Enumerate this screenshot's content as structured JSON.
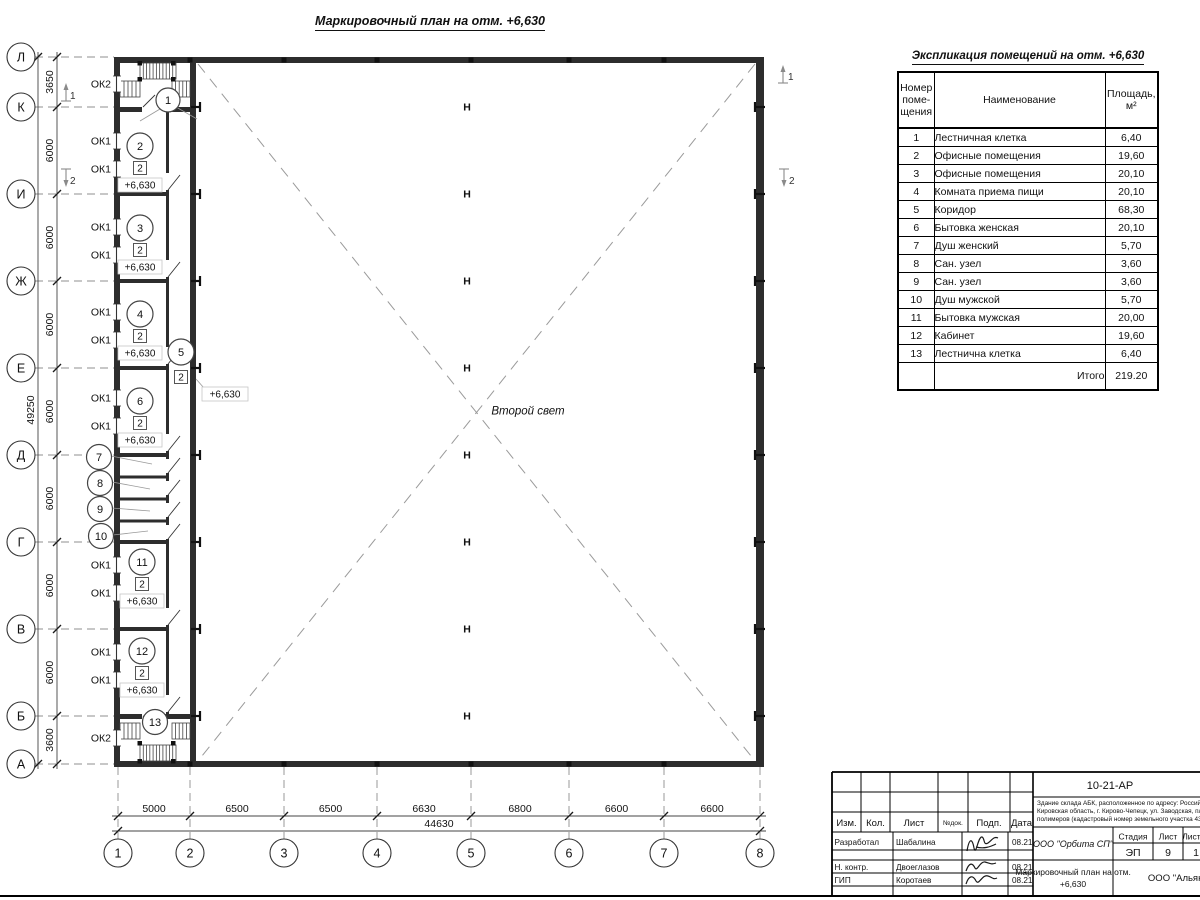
{
  "plan": {
    "title": "Маркировочный план на отм. +6,630",
    "second_light": "Второй свет",
    "elevation": "+6,630",
    "square_mark": "2",
    "column_mark": "Н",
    "axes_rows": [
      "Л",
      "К",
      "И",
      "Ж",
      "Е",
      "Д",
      "Г",
      "В",
      "Б",
      "А"
    ],
    "axes_cols": [
      "1",
      "2",
      "3",
      "4",
      "5",
      "6",
      "7",
      "8"
    ],
    "dims_vertical": [
      "3650",
      "6000",
      "6000",
      "6000",
      "6000",
      "6000",
      "6000",
      "6000",
      "3600"
    ],
    "dim_vertical_total": "49250",
    "dims_horizontal": [
      "5000",
      "6500",
      "6500",
      "6630",
      "6800",
      "6600",
      "6600"
    ],
    "dim_horizontal_total": "44630",
    "windows": [
      "ОК2",
      "ОК1",
      "ОК1",
      "ОК1",
      "ОК1",
      "ОК1",
      "ОК1",
      "ОК1",
      "ОК1",
      "ОК1",
      "ОК1",
      "ОК1",
      "ОК1",
      "ОК2"
    ],
    "rooms": [
      "1",
      "2",
      "3",
      "4",
      "5",
      "6",
      "7",
      "8",
      "9",
      "10",
      "11",
      "12",
      "13"
    ],
    "section_marks": [
      "1",
      "2"
    ]
  },
  "table": {
    "title": "Экспликация помещений на отм. +6,630",
    "headers": [
      "Номер\nпоме-\nщения",
      "Наименование",
      "Площадь,\nм²"
    ],
    "rows": [
      {
        "num": "1",
        "name": "Лестничная клетка",
        "area": "6,40"
      },
      {
        "num": "2",
        "name": "Офисные помещения",
        "area": "19,60"
      },
      {
        "num": "3",
        "name": "Офисные помещения",
        "area": "20,10"
      },
      {
        "num": "4",
        "name": "Комната приема пищи",
        "area": "20,10"
      },
      {
        "num": "5",
        "name": "Коридор",
        "area": "68,30"
      },
      {
        "num": "6",
        "name": "Бытовка женская",
        "area": "20,10"
      },
      {
        "num": "7",
        "name": "Душ женский",
        "area": "5,70"
      },
      {
        "num": "8",
        "name": "Сан. узел",
        "area": "3,60"
      },
      {
        "num": "9",
        "name": "Сан. узел",
        "area": "3,60"
      },
      {
        "num": "10",
        "name": "Душ мужской",
        "area": "5,70"
      },
      {
        "num": "11",
        "name": "Бытовка мужская",
        "area": "20,00"
      },
      {
        "num": "12",
        "name": "Кабинет",
        "area": "19,60"
      },
      {
        "num": "13",
        "name": "Лестнична клетка",
        "area": "6,40"
      }
    ],
    "total_label": "Итого",
    "total_value": "219.20"
  },
  "titleblock": {
    "doc_number": "10-21-АР",
    "desc_lines": [
      "Здание склада АБК, расположенное по адресу: Российская Феде",
      "Кировская область, г. Кирово-Чепецк, ул. Заводская, площадка з",
      "полимеров (кадастровый номер земельного участка 43:42:0000"
    ],
    "columns": [
      "Изм.",
      "Кол.",
      "Лист",
      "№док.",
      "Подп.",
      "Дата"
    ],
    "rows": [
      {
        "role": "Разработал",
        "name": "Шабалина",
        "date": "08.21"
      },
      {
        "role": "Н. контр.",
        "name": "Двоеглазов",
        "date": "08.21"
      },
      {
        "role": "ГИП",
        "name": "Коротаев",
        "date": "08.21"
      }
    ],
    "org": "ООО \"Орбита СП\"",
    "stage_label": "Стадия",
    "sheet_label": "Лист",
    "sheets_label": "Листов",
    "stage": "ЭП",
    "sheet": "9",
    "sheets": "1",
    "drawing_title_lines": [
      "Маркировочный план на отм.",
      "+6,630"
    ],
    "company": "ООО \"Альянс"
  }
}
